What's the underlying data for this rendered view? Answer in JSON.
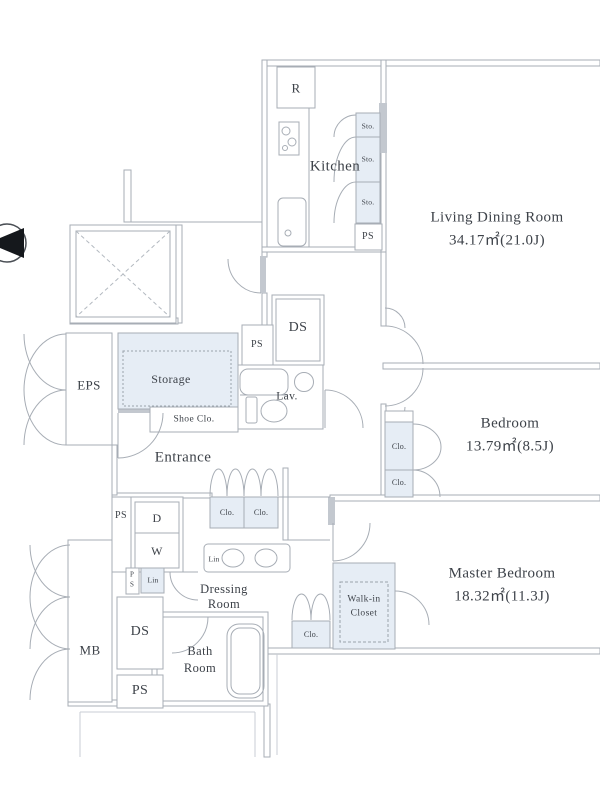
{
  "title": "Apartment floor plan",
  "colors": {
    "wall": "#a7adb5",
    "wall_dark": "#c3c8cf",
    "text": "#3d4249",
    "closet_fill": "#e6edf5",
    "line_light": "#c9ced4"
  },
  "rooms": {
    "living": {
      "name": "Living Dining Room",
      "area": "34.17㎡(21.0J)"
    },
    "bedroom": {
      "name": "Bedroom",
      "area": "13.79㎡(8.5J)"
    },
    "master": {
      "name": "Master Bedroom",
      "area": "18.32㎡(11.3J)"
    },
    "kitchen": {
      "name": "Kitchen"
    },
    "entrance": {
      "name": "Entrance"
    },
    "storage": {
      "name": "Storage"
    },
    "lav": {
      "name": "Lav."
    },
    "dressing": {
      "line1": "Dressing",
      "line2": "Room"
    },
    "bath": {
      "line1": "Bath",
      "line2": "Room"
    },
    "walkin": {
      "line1": "Walk-in",
      "line2": "Closet"
    }
  },
  "labels": {
    "eps": "EPS",
    "mb": "MB",
    "ds": "DS",
    "ps": "PS",
    "shoe_closet": "Shoe Clo.",
    "closet": "Clo.",
    "storage_small": "Sto.",
    "linen": "Lin",
    "fridge": "R",
    "dryer": "D",
    "washer": "W",
    "p": "P",
    "s": "S"
  }
}
